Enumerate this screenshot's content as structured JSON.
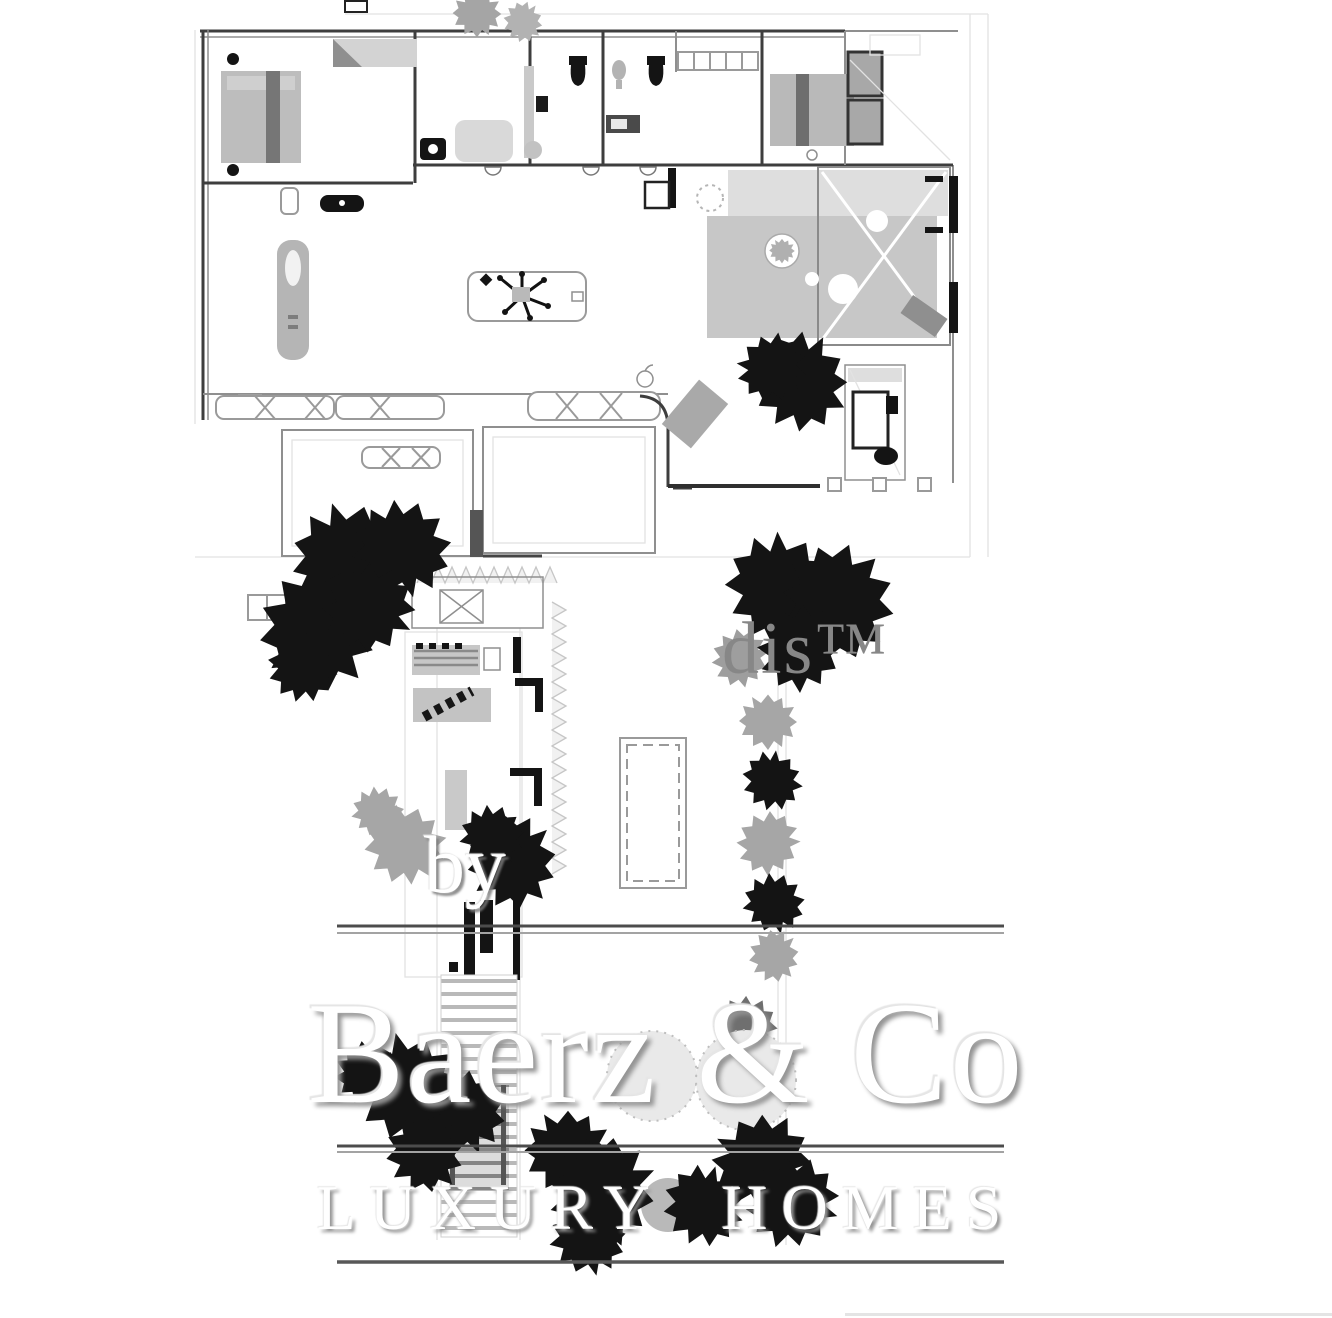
{
  "watermarks": {
    "partner": "dis™",
    "byline": "by",
    "brand": "Baerz & Co",
    "tagline": "LUXURY HOMES"
  },
  "colors": {
    "ink": "#141414",
    "wall_dark": "#3e3e3e",
    "wall_mid": "#8f8f8f",
    "line_faint": "#e2e2e2",
    "gray_light": "#dedede",
    "gray_mid": "#c7c7c7",
    "gray_dark": "#6f6f6f",
    "shrub_gray": "#a6a6a6",
    "rule_dark": "#4c4c4c",
    "rule_light": "#a3a3a3",
    "watermark_white": "#ffffff",
    "watermark_shadow": "#949494",
    "dis_gray": "#878787"
  }
}
